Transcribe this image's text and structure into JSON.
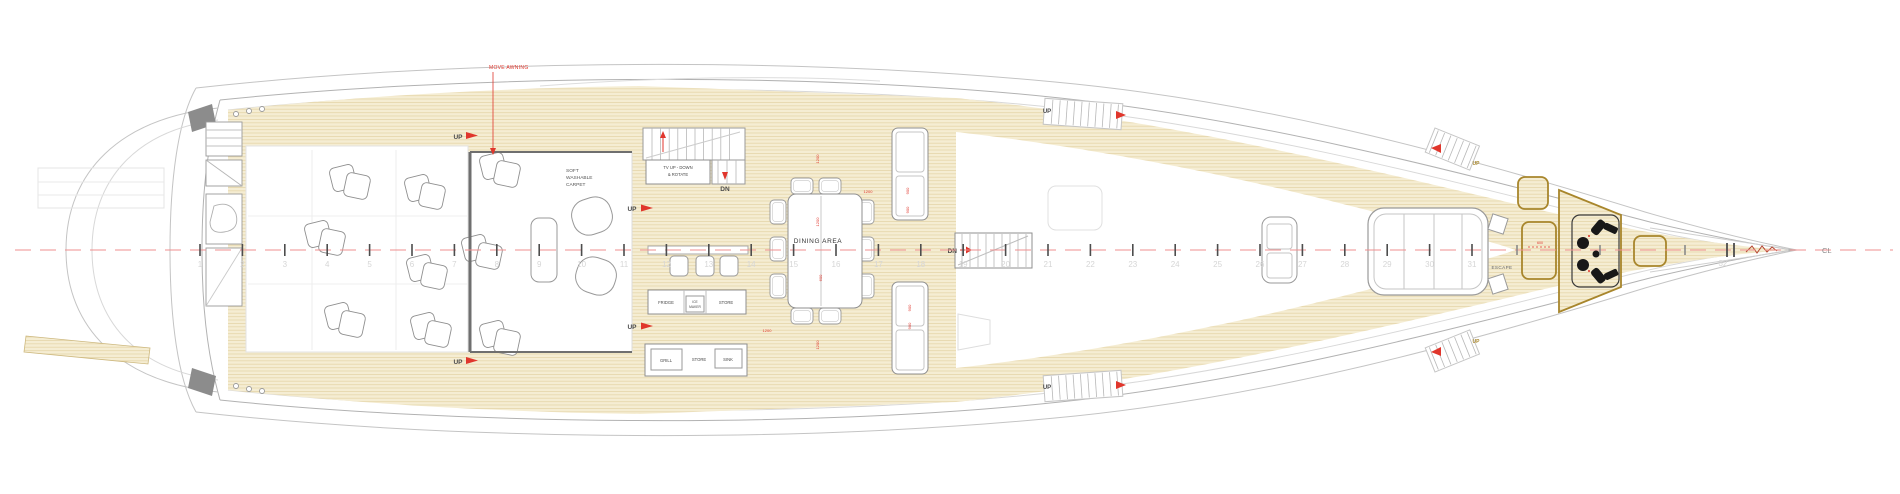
{
  "drawing": {
    "title": "yacht main deck general arrangement plan",
    "centerline_label": "CL",
    "annotations": {
      "awning_note": "MOVE AWNING",
      "up_label": "UP",
      "down_label": "DN",
      "escape_label": "ESCAPE"
    },
    "rooms": {
      "saloon_note_lines": [
        "SOFT",
        "WASHABLE",
        "CARPET"
      ],
      "tv_note_lines": [
        "TV UP - DOWN",
        "& ROTATE"
      ],
      "dining_label": "DINING AREA",
      "galley_forward_units": [
        "FRIDGE",
        "ICE",
        "MAKER",
        "STORE"
      ],
      "galley_aft_units": [
        "GRILL",
        "STORE",
        "SINK"
      ]
    },
    "dimensions": {
      "d1": "1200",
      "d2": "1200",
      "d3": "1200",
      "d4": "600",
      "d5": "1200",
      "d6": "1200",
      "c1": "900",
      "c2": "900",
      "c3": "900",
      "c4": "900",
      "bow": "600"
    },
    "stations": {
      "first": 1,
      "last": 32
    },
    "colors": {
      "teak": "#f5edd3",
      "plank": "#e3d2a4",
      "gold": "#a8862c",
      "centerline": "#ef8f8f",
      "annotation_red": "#e0362c",
      "hull_line": "#bcbcbc",
      "wall": "#6f6f6f",
      "equipment_black": "#181818",
      "station_text": "#d6d6d6"
    }
  }
}
